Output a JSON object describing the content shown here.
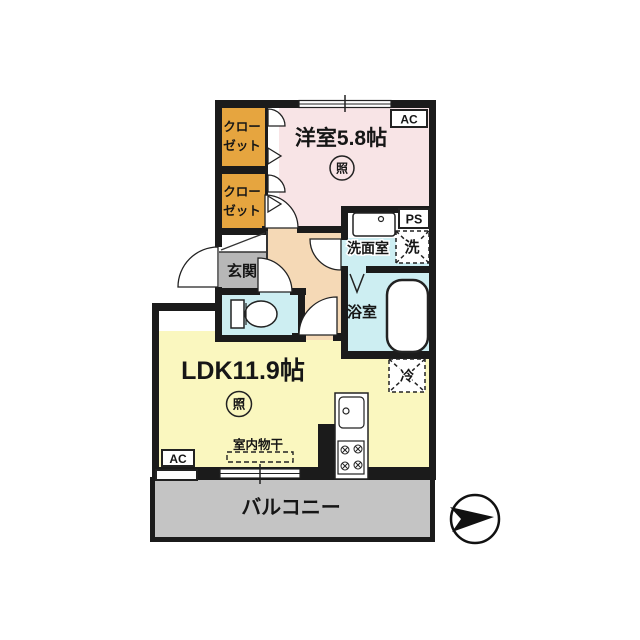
{
  "labels": {
    "western_room": "洋室5.8帖",
    "ldk": "LDK11.9帖",
    "balcony": "バルコニー",
    "entrance": "玄関",
    "washroom": "洗面室",
    "bathroom": "浴室",
    "closet_line1": "クロー",
    "closet_line2": "ゼット",
    "washer": "洗",
    "fridge": "冷",
    "light": "照",
    "indoor_drying": "室内物干",
    "ac": "AC",
    "ps": "PS"
  },
  "colors": {
    "wall": "#1b1b1b",
    "western_room": "#f8e4e6",
    "closet": "#e6a53f",
    "hall": "#f5d9b6",
    "wet_area": "#cdeef2",
    "ldk": "#faf7bf",
    "balcony": "#c4c4c4",
    "entrance": "#b7b7b7"
  }
}
